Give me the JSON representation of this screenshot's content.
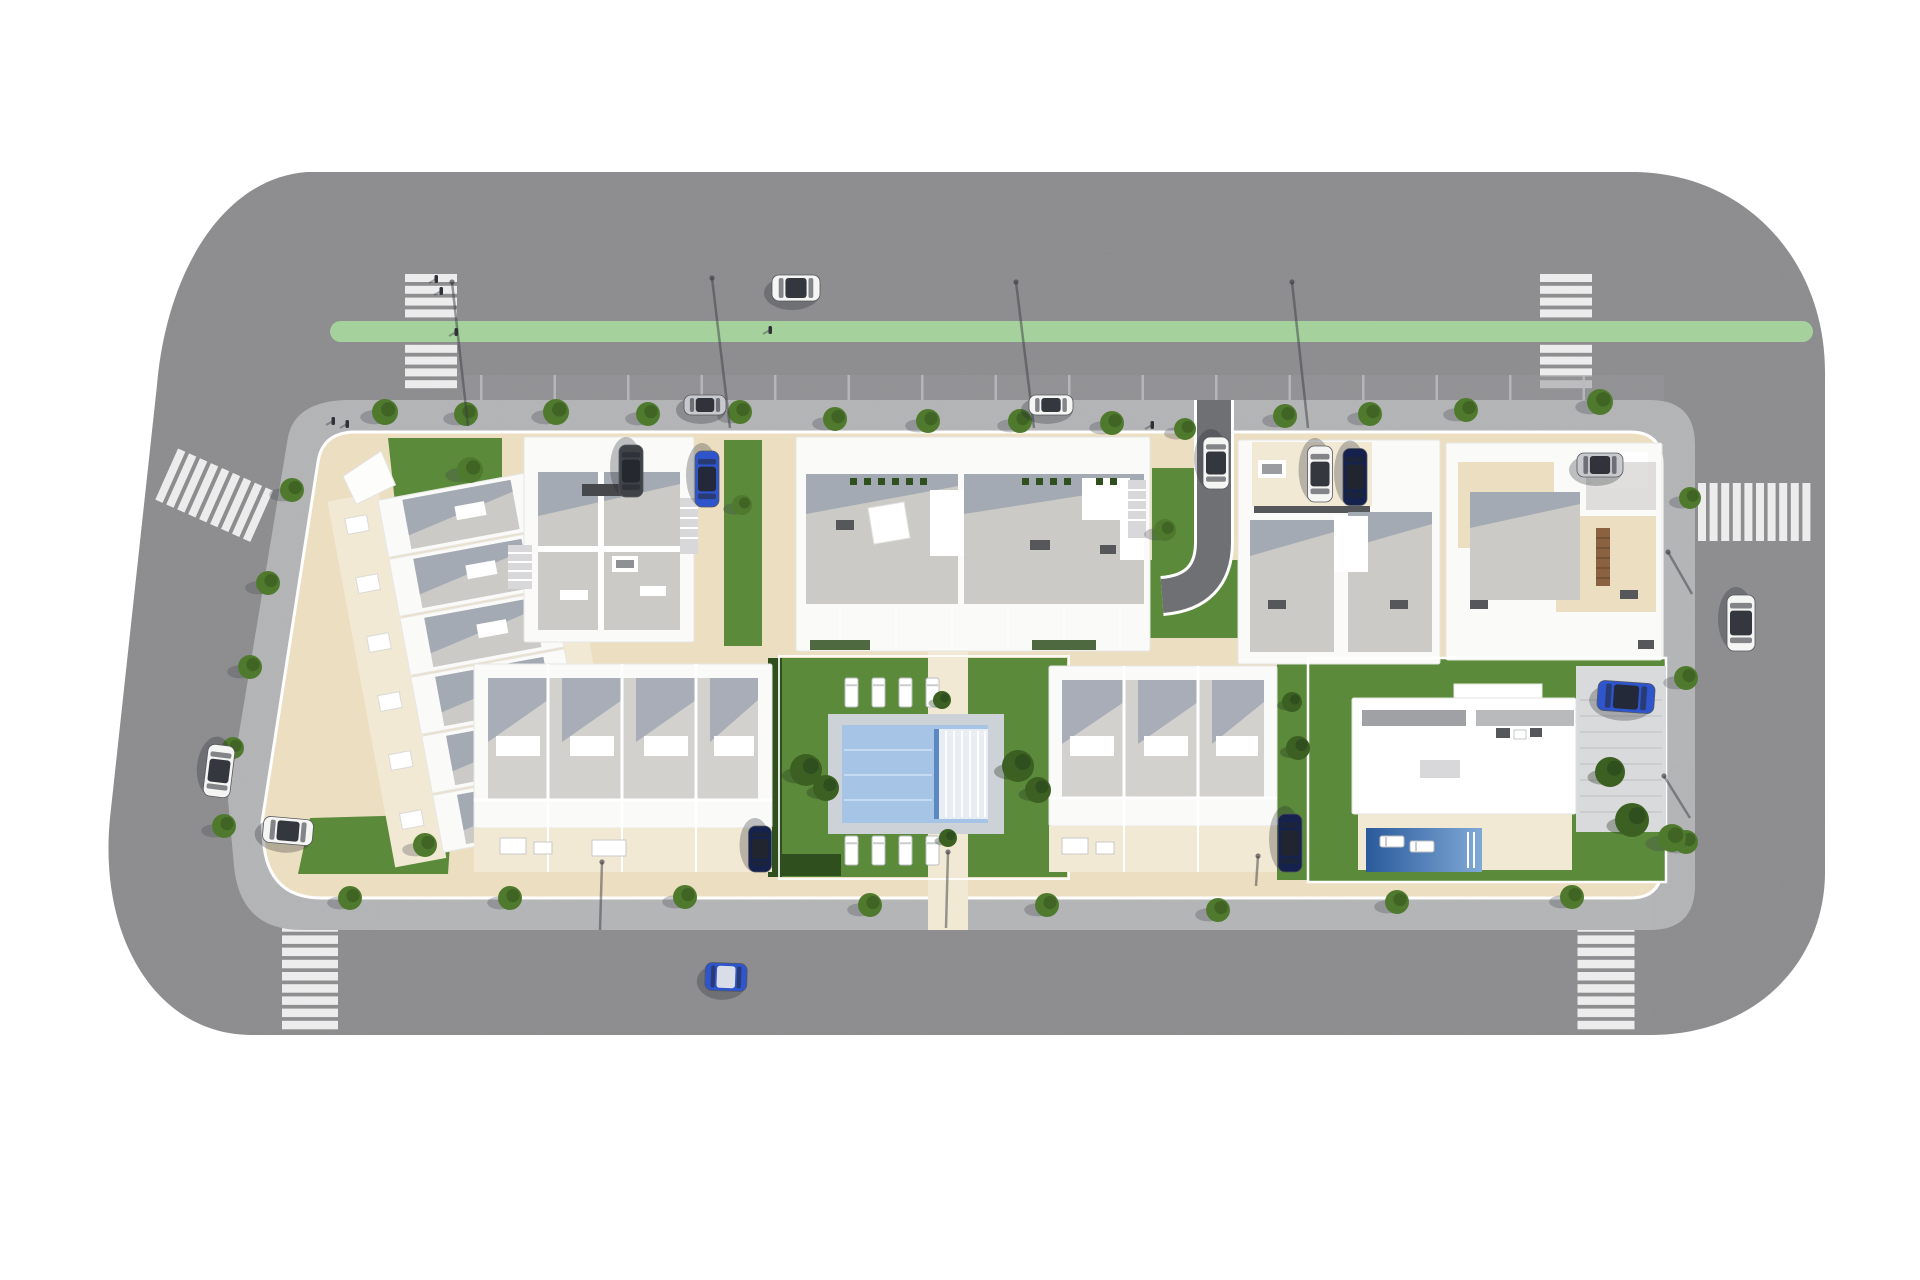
{
  "meta": {
    "scene_kind": "aerial-3d-site-plan-render",
    "subject": "residential development block with apartment buildings, townhouses, communal pool, villa, perimeter roads"
  },
  "palette": {
    "bg": "#ffffff",
    "road": "#8d8d8f",
    "road_band": "#98989a",
    "tick": "#b9babc",
    "stripe": "#ececec",
    "lane_green": "#a5d19d",
    "sidewalk": "#b4b5b7",
    "plot": "#ecdfc1",
    "terrace": "#f2e9d4",
    "building_white": "#fafaf9",
    "building_edge": "#e6e6e4",
    "roof_gray": "#cbcac6",
    "roof_light": "#d2d1ce",
    "roof_dark": "#9fa1a4",
    "shadow": "#7d89a0",
    "lawn": "#5a8a3a",
    "lawn_dark": "#3f6628",
    "hedge": "#2f4f1e",
    "tree": "#4f7a2e",
    "tree_dark": "#3c5f22",
    "deck": "#cdd2d8",
    "water": "#a6c4e6",
    "water_line": "#c6dbf2",
    "pool_edge": "#5b87c2",
    "villa_pool_deep": "#2a5a9c",
    "villa_pool_light": "#7fa9d6",
    "drive_asphalt": "#6f7073",
    "pave_light": "#d9dadc",
    "wood": "#8a6242",
    "car_white": "#f5f5f4",
    "car_silver": "#c8c9cc",
    "car_blue": "#2f55cc",
    "car_navy": "#15224d",
    "car_dark": "#3f4247",
    "car_windows": "#23262d",
    "lamp": "#3d3f45"
  },
  "scene": {
    "green_lane": {
      "x": 330,
      "y": 321,
      "w": 1483,
      "h": 21,
      "r": 10.5
    },
    "parking_band": {
      "x": 462,
      "y": 375,
      "w": 1202,
      "h": 25
    },
    "parking_ticks": {
      "x1": 480,
      "x2": 1655,
      "y": 375,
      "h": 25,
      "step": 73.5
    },
    "crosswalks": [
      {
        "id": "crosswalk-top-left",
        "cx": 431,
        "cy": 333,
        "rot": 0,
        "dir": "h",
        "count": 10,
        "step": 11.8,
        "len": 52,
        "thick": 8
      },
      {
        "id": "crosswalk-top-right",
        "cx": 1566,
        "cy": 333,
        "rot": 0,
        "dir": "h",
        "count": 10,
        "step": 11.8,
        "len": 52,
        "thick": 8
      },
      {
        "id": "crosswalk-bottom-left",
        "cx": 310,
        "cy": 972,
        "rot": 0,
        "dir": "h",
        "count": 10,
        "step": 12.2,
        "len": 56,
        "thick": 8.5
      },
      {
        "id": "crosswalk-bottom-right",
        "cx": 1606,
        "cy": 972,
        "rot": 0,
        "dir": "h",
        "count": 10,
        "step": 12.2,
        "len": 57,
        "thick": 8.5
      },
      {
        "id": "crosswalk-right",
        "cx": 1756,
        "cy": 512,
        "rot": 0,
        "dir": "v",
        "count": 10,
        "step": 11.6,
        "len": 58,
        "thick": 8
      },
      {
        "id": "crosswalk-left",
        "cx": 216,
        "cy": 496,
        "rot": 24,
        "dir": "v",
        "count": 9,
        "step": 12,
        "len": 56,
        "thick": 8
      }
    ],
    "trees": [
      {
        "x": 385,
        "y": 412,
        "r": 13
      },
      {
        "x": 466,
        "y": 414,
        "r": 12
      },
      {
        "x": 556,
        "y": 412,
        "r": 13
      },
      {
        "x": 648,
        "y": 414,
        "r": 12
      },
      {
        "x": 740,
        "y": 412,
        "r": 12
      },
      {
        "x": 835,
        "y": 419,
        "r": 12
      },
      {
        "x": 928,
        "y": 421,
        "r": 12
      },
      {
        "x": 1020,
        "y": 421,
        "r": 12
      },
      {
        "x": 1112,
        "y": 423,
        "r": 12
      },
      {
        "x": 1185,
        "y": 429,
        "r": 11
      },
      {
        "x": 1285,
        "y": 416,
        "r": 12
      },
      {
        "x": 1370,
        "y": 414,
        "r": 12
      },
      {
        "x": 1466,
        "y": 410,
        "r": 12
      },
      {
        "x": 1600,
        "y": 402,
        "r": 13
      },
      {
        "x": 292,
        "y": 490,
        "r": 12
      },
      {
        "x": 268,
        "y": 583,
        "r": 12
      },
      {
        "x": 250,
        "y": 667,
        "r": 12
      },
      {
        "x": 233,
        "y": 748,
        "r": 11
      },
      {
        "x": 224,
        "y": 826,
        "r": 12
      },
      {
        "x": 350,
        "y": 898,
        "r": 12
      },
      {
        "x": 510,
        "y": 898,
        "r": 12
      },
      {
        "x": 685,
        "y": 897,
        "r": 12
      },
      {
        "x": 870,
        "y": 905,
        "r": 12
      },
      {
        "x": 1047,
        "y": 905,
        "r": 12
      },
      {
        "x": 1218,
        "y": 910,
        "r": 12
      },
      {
        "x": 1397,
        "y": 902,
        "r": 12
      },
      {
        "x": 1572,
        "y": 897,
        "r": 12
      },
      {
        "x": 1690,
        "y": 498,
        "r": 11
      },
      {
        "x": 1686,
        "y": 678,
        "r": 12
      },
      {
        "x": 1686,
        "y": 842,
        "r": 12
      },
      {
        "x": 470,
        "y": 470,
        "r": 13
      },
      {
        "x": 425,
        "y": 845,
        "r": 12
      },
      {
        "x": 1165,
        "y": 530,
        "r": 11
      },
      {
        "x": 742,
        "y": 505,
        "r": 10
      },
      {
        "x": 1672,
        "y": 838,
        "r": 14
      }
    ],
    "bushes": [
      {
        "x": 806,
        "y": 770,
        "r": 16
      },
      {
        "x": 826,
        "y": 788,
        "r": 13
      },
      {
        "x": 1018,
        "y": 766,
        "r": 16
      },
      {
        "x": 1038,
        "y": 790,
        "r": 13
      },
      {
        "x": 942,
        "y": 700,
        "r": 9
      },
      {
        "x": 948,
        "y": 838,
        "r": 9
      },
      {
        "x": 1610,
        "y": 772,
        "r": 15
      },
      {
        "x": 1632,
        "y": 820,
        "r": 17
      },
      {
        "x": 1292,
        "y": 702,
        "r": 10
      },
      {
        "x": 1298,
        "y": 748,
        "r": 12
      }
    ],
    "loungers": [
      {
        "x": 845,
        "y": 678,
        "w": 13,
        "h": 29
      },
      {
        "x": 872,
        "y": 678,
        "w": 13,
        "h": 29
      },
      {
        "x": 899,
        "y": 678,
        "w": 13,
        "h": 29
      },
      {
        "x": 926,
        "y": 678,
        "w": 13,
        "h": 29
      },
      {
        "x": 845,
        "y": 836,
        "w": 13,
        "h": 29
      },
      {
        "x": 872,
        "y": 836,
        "w": 13,
        "h": 29
      },
      {
        "x": 899,
        "y": 836,
        "w": 13,
        "h": 29
      },
      {
        "x": 926,
        "y": 836,
        "w": 13,
        "h": 29
      },
      {
        "x": 1380,
        "y": 836,
        "w": 24,
        "h": 11
      },
      {
        "x": 1410,
        "y": 841,
        "w": 24,
        "h": 11
      }
    ],
    "lamps": [
      {
        "x1": 452,
        "y1": 282,
        "x2": 468,
        "y2": 426
      },
      {
        "x1": 712,
        "y1": 278,
        "x2": 730,
        "y2": 428
      },
      {
        "x1": 1016,
        "y1": 282,
        "x2": 1034,
        "y2": 428
      },
      {
        "x1": 1292,
        "y1": 282,
        "x2": 1308,
        "y2": 428
      },
      {
        "x1": 1668,
        "y1": 552,
        "x2": 1692,
        "y2": 594
      },
      {
        "x1": 1664,
        "y1": 776,
        "x2": 1690,
        "y2": 818
      },
      {
        "x1": 602,
        "y1": 862,
        "x2": 600,
        "y2": 930
      },
      {
        "x1": 948,
        "y1": 852,
        "x2": 946,
        "y2": 928
      },
      {
        "x1": 1258,
        "y1": 856,
        "x2": 1256,
        "y2": 886
      }
    ],
    "people": [
      {
        "x": 333,
        "y": 421
      },
      {
        "x": 347,
        "y": 424
      },
      {
        "x": 436,
        "y": 279
      },
      {
        "x": 441,
        "y": 291
      },
      {
        "x": 456,
        "y": 332
      },
      {
        "x": 1152,
        "y": 425
      },
      {
        "x": 770,
        "y": 330
      }
    ],
    "cars": [
      {
        "id": "car-sedan-top-road",
        "cx": 796,
        "cy": 288,
        "l": 48,
        "w": 26,
        "rot": 0,
        "color": "car_white"
      },
      {
        "id": "car-parked-top-lane-1",
        "cx": 705,
        "cy": 405,
        "l": 42,
        "w": 20,
        "rot": 0,
        "color": "car_silver"
      },
      {
        "id": "car-parked-top-lane-2",
        "cx": 1051,
        "cy": 405,
        "l": 44,
        "w": 20,
        "rot": 0,
        "color": "car_white"
      },
      {
        "id": "car-on-driveway",
        "cx": 1216,
        "cy": 463,
        "l": 52,
        "w": 26,
        "rot": 90,
        "color": "car_white"
      },
      {
        "id": "van-dark-block-a",
        "cx": 631,
        "cy": 471,
        "l": 52,
        "w": 24,
        "rot": 90,
        "color": "car_dark"
      },
      {
        "id": "car-blue-block-a",
        "cx": 707,
        "cy": 479,
        "l": 56,
        "w": 24,
        "rot": 90,
        "color": "car_blue"
      },
      {
        "id": "car-white-block-c",
        "cx": 1320,
        "cy": 474,
        "l": 56,
        "w": 25,
        "rot": 90,
        "color": "car_white"
      },
      {
        "id": "car-navy-block-c",
        "cx": 1355,
        "cy": 477,
        "l": 57,
        "w": 24,
        "rot": 90,
        "color": "car_navy"
      },
      {
        "id": "car-silver-block-d",
        "cx": 1600,
        "cy": 465,
        "l": 46,
        "w": 24,
        "rot": 0,
        "color": "car_silver"
      },
      {
        "id": "car-white-left-road",
        "cx": 219,
        "cy": 771,
        "l": 52,
        "w": 27,
        "rot": 97,
        "color": "car_white"
      },
      {
        "id": "car-white-corner-park",
        "cx": 288,
        "cy": 831,
        "l": 50,
        "w": 26,
        "rot": 5,
        "color": "car_white"
      },
      {
        "id": "car-navy-south-block-a",
        "cx": 760,
        "cy": 849,
        "l": 46,
        "w": 23,
        "rot": 90,
        "color": "car_navy"
      },
      {
        "id": "car-navy-south-block-b",
        "cx": 1290,
        "cy": 843,
        "l": 58,
        "w": 24,
        "rot": 90,
        "color": "car_navy"
      },
      {
        "id": "car-blue-villa",
        "cx": 1626,
        "cy": 697,
        "l": 57,
        "w": 30,
        "rot": 4,
        "color": "car_blue"
      },
      {
        "id": "car-blue-bottom-road",
        "cx": 726,
        "cy": 977,
        "l": 42,
        "w": 28,
        "rot": 2,
        "color": "car_blue",
        "roof": "#e8e9ea"
      },
      {
        "id": "car-white-right-road",
        "cx": 1741,
        "cy": 623,
        "l": 56,
        "w": 28,
        "rot": 90,
        "color": "car_white"
      }
    ]
  }
}
